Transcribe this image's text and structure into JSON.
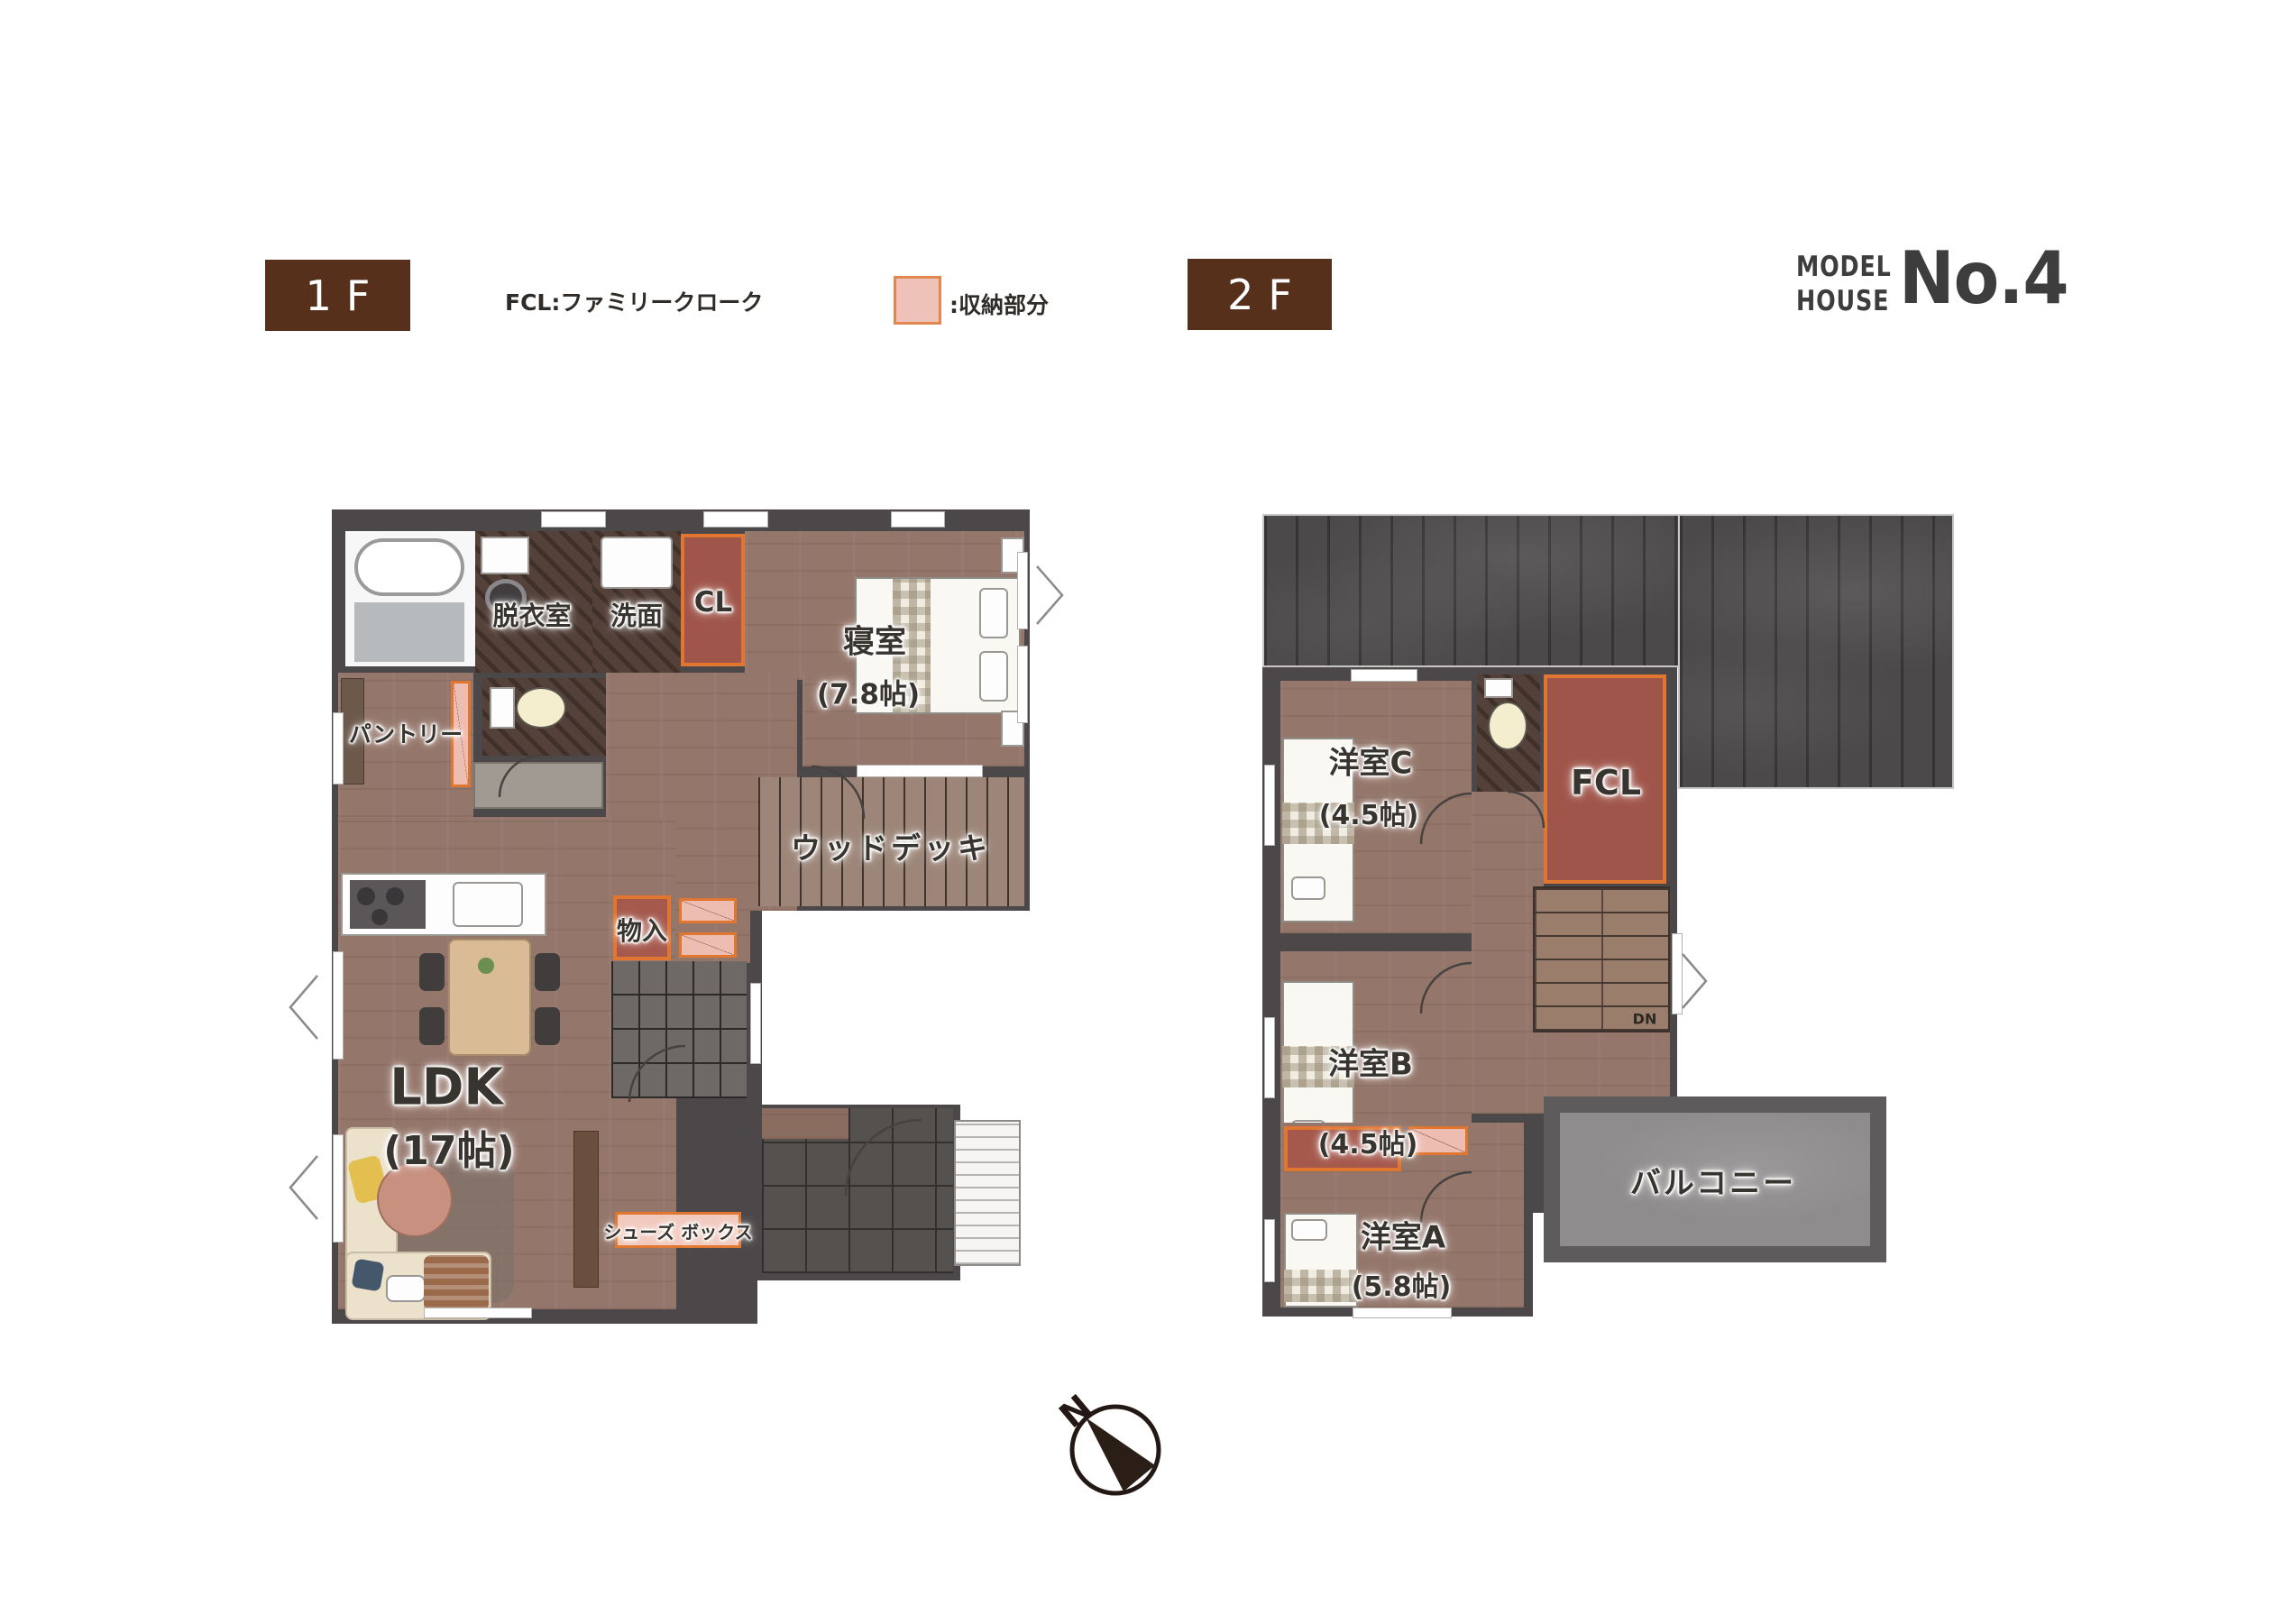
{
  "header": {
    "floor1_label": "1F",
    "fcl_note": "FCL:ファミリークローク",
    "storage_note": ":収納部分",
    "floor2_label": "2F",
    "brand_line1": "MODEL",
    "brand_line2": "HOUSE",
    "brand_number": "No.4"
  },
  "colors": {
    "badge_brown": "#56301b",
    "wall_gray": "#4c4849",
    "wood_floor": "#94766a",
    "storage_red": "#a7564a",
    "storage_pink": "#eebdb2",
    "storage_border_orange": "#e0762f",
    "roof_gray": "#4b494a",
    "balcony_gray": "#8f8c8d"
  },
  "floor1": {
    "rooms": {
      "dressing": "脱衣室",
      "washroom": "洗面",
      "closet": "CL",
      "bedroom": "寝室",
      "bedroom_size": "(7.8帖)",
      "pantry": "パントリー",
      "wood_deck": "ウッドデッキ",
      "storage": "物入",
      "ldk": "LDK",
      "ldk_size": "(17帖)",
      "shoe_box": "シューズ ボックス"
    }
  },
  "floor2": {
    "rooms": {
      "room_c": "洋室C",
      "room_c_size": "(4.5帖)",
      "fcl": "FCL",
      "room_b": "洋室B",
      "room_b_size": "(4.5帖)",
      "room_a": "洋室A",
      "room_a_size": "(5.8帖)",
      "balcony": "バルコニー",
      "stairs_down": "DN"
    }
  },
  "compass": {
    "north_label": "N"
  }
}
